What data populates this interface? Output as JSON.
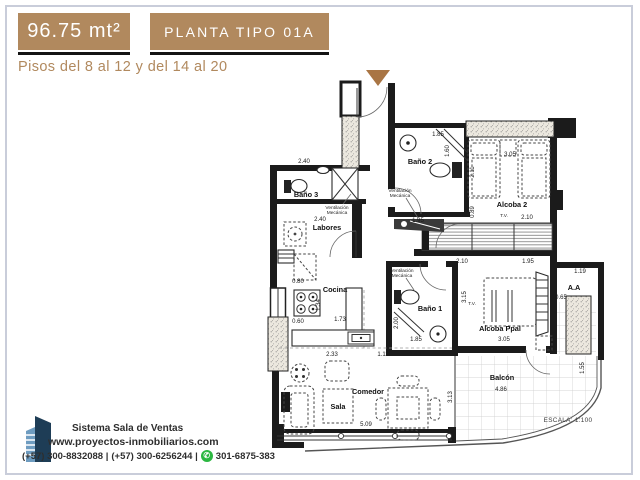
{
  "header": {
    "area": "96.75 mt²",
    "plan_name": "PLANTA TIPO 01A",
    "floors": "Pisos del 8 al 12 y del 14 al 20"
  },
  "plan": {
    "rooms": {
      "bano3": "Baño 3",
      "labores": "Labores",
      "cocina": "Cocina",
      "sala": "Sala",
      "comedor": "Comedor",
      "bano2": "Baño 2",
      "alcoba2": "Alcoba 2",
      "bano1": "Baño 1",
      "alcoba_ppal": "Alcoba Ppal",
      "aa": "A.A",
      "balcon": "Balcón"
    },
    "vent": {
      "l1": "Ventilación",
      "l2": "Mecánica"
    },
    "tv": "T.V.",
    "scale": "ESCALA: 1:100",
    "dims": {
      "d_bano3_w": "2.40",
      "d_labores_w": "2.40",
      "d_080": "0.80",
      "d_060": "0.60",
      "d_134": "1.34",
      "d_173": "1.73",
      "d_233": "2.33",
      "d_111": "1.11",
      "d_143": "1.43",
      "d_509": "5.09",
      "d_313": "3.13",
      "d_bano2_w": "1.85",
      "d_160": "1.60",
      "d_195a": "1.95",
      "d_089": "0.89",
      "d_211": "2.11",
      "d_alcoba2_w": "3.05",
      "d_210a": "2.10",
      "d_210b": "2.10",
      "d_195b": "1.95",
      "d_315": "3.15",
      "d_200": "2.00",
      "d_bano1_w": "1.85",
      "d_appal_w": "3.05",
      "d_119": "1.19",
      "d_065": "0.65",
      "d_486": "4.86",
      "d_155": "1.55"
    }
  },
  "footer": {
    "company": "Sistema Sala de Ventas",
    "website": "www.proyectos-inmobiliarios.com",
    "phone1": "(+57) 300-8832088  |",
    "phone2": "(+57) 300-6256244 |",
    "whatsapp_number": "301-6875-383"
  },
  "colors": {
    "accent": "#b1895e",
    "underline": "#141414",
    "wall": "#1b1b1b",
    "arrow": "#a97544",
    "whatsapp": "#2bb741",
    "logo_navy": "#1e3d56"
  }
}
